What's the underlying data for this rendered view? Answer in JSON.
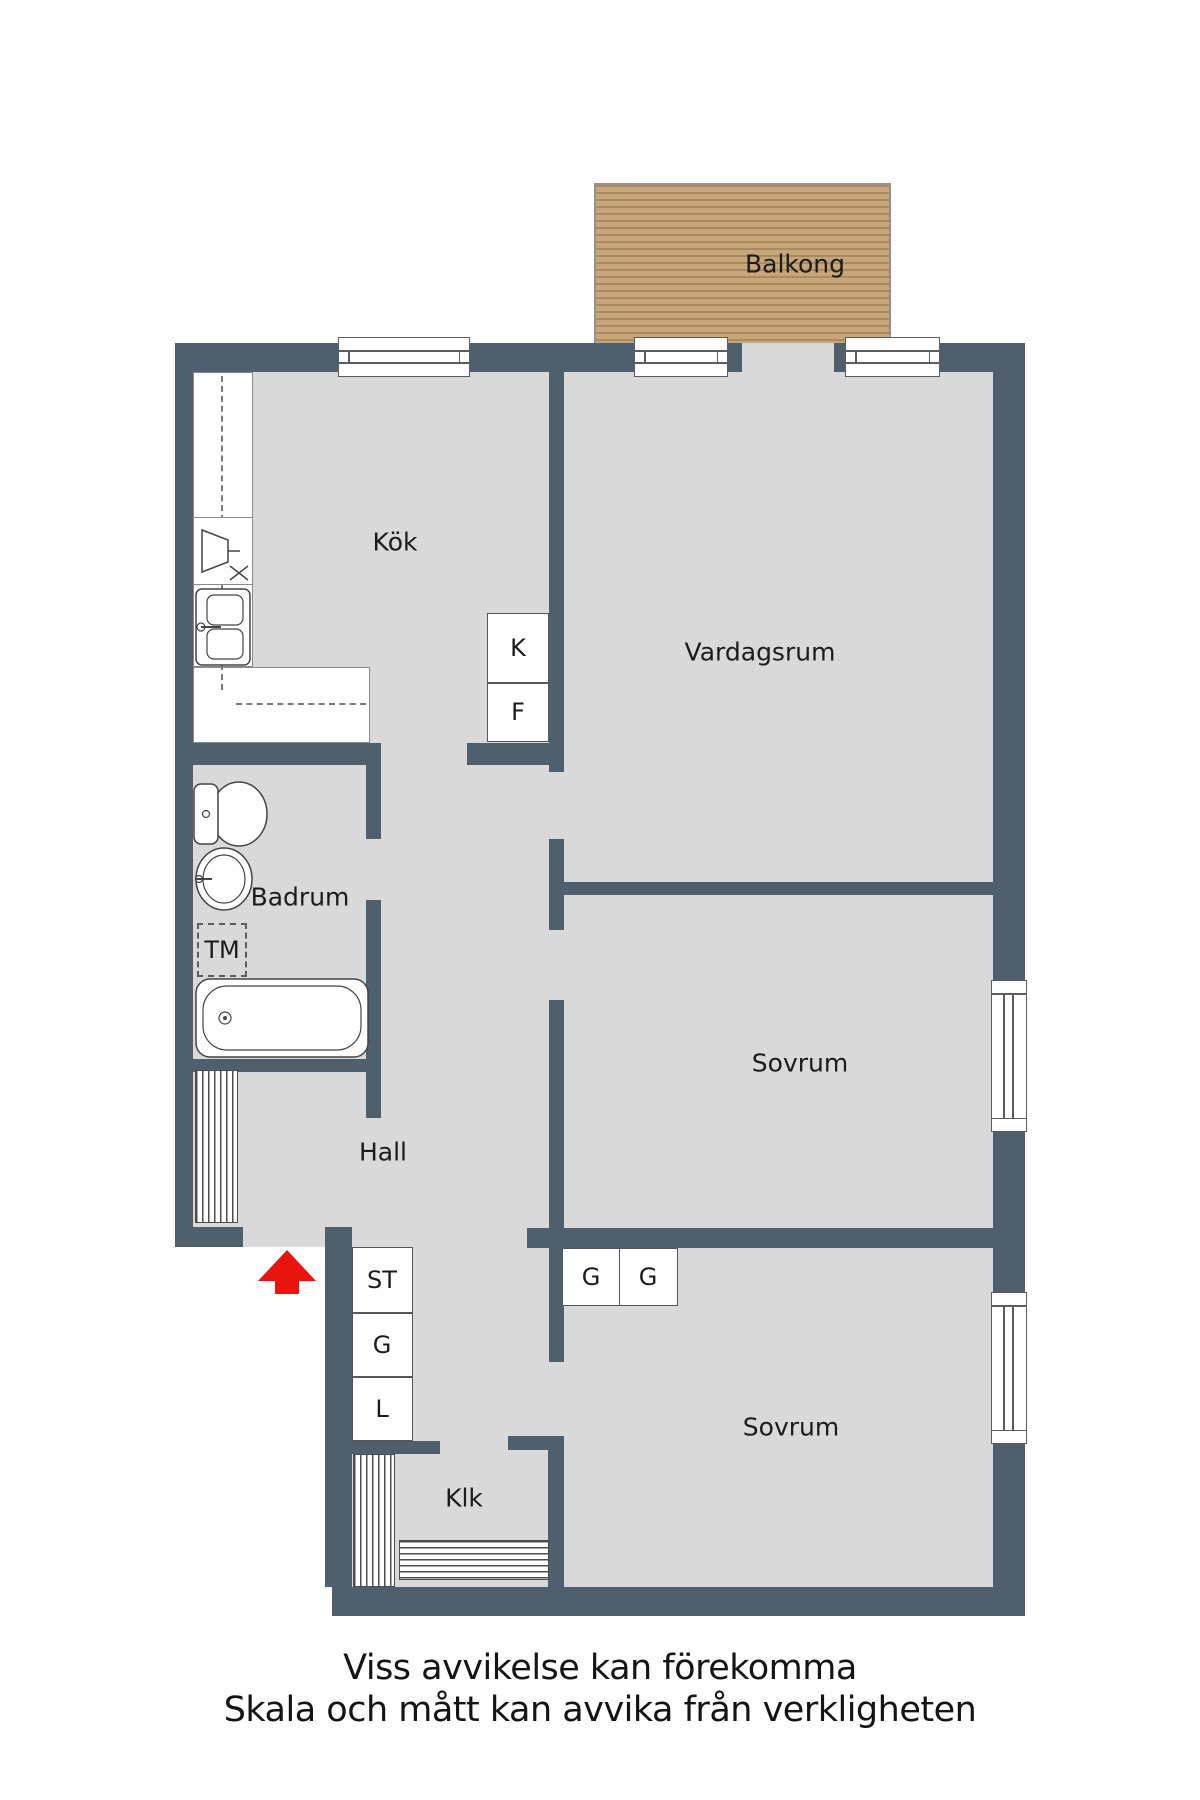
{
  "plan": {
    "room_labels": {
      "balkong": "Balkong",
      "kok": "Kök",
      "vardagsrum": "Vardagsrum",
      "badrum": "Badrum",
      "hall": "Hall",
      "sovrum1": "Sovrum",
      "sovrum2": "Sovrum",
      "klk": "Klk"
    },
    "fixture_labels": {
      "kyl": "K",
      "frys": "F",
      "tvattmaskin": "TM",
      "stad": "ST",
      "garderob_hall": "G",
      "linne": "L",
      "garderob_sovrum_1": "G",
      "garderob_sovrum_2": "G"
    },
    "disclaimer": {
      "line1": "Viss avvikelse kan förekomma",
      "line2": "Skala och mått kan avvika från verkligheten"
    },
    "colors": {
      "wall": "#4f5f6d",
      "floor": "#d9d9d9",
      "balcony_wood": "#c7a67a",
      "arrow_red": "#e8150f"
    }
  }
}
